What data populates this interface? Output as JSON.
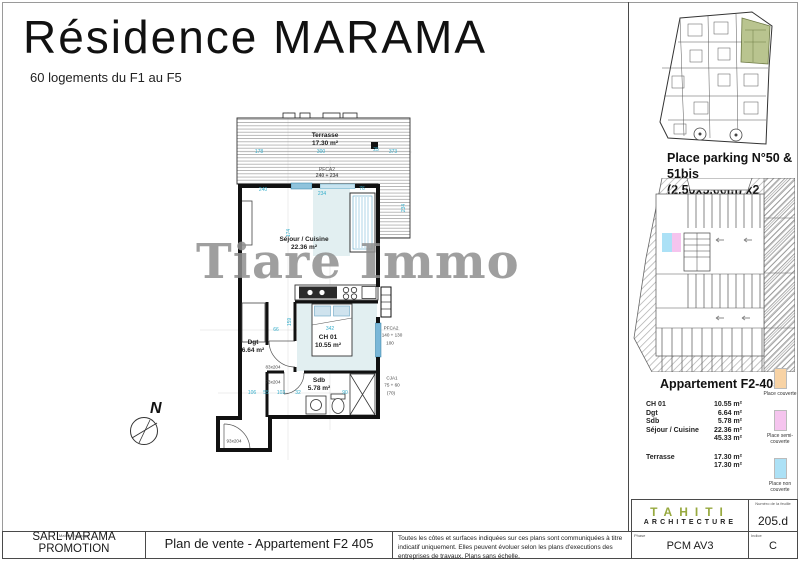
{
  "header": {
    "title": "Résidence MARAMA",
    "subtitle": "60 logements du F1 au F5"
  },
  "watermark": "Tiare Immo",
  "plan": {
    "compass": "N",
    "room_labels": [
      {
        "name": "Terrasse",
        "area": "17.30 m²",
        "x": 325,
        "y": 140
      },
      {
        "name": "PFCA2",
        "area": "240 + 234",
        "x": 327,
        "y": 173,
        "cls": "small"
      },
      {
        "name": "Séjour / Cuisine",
        "area": "22.36 m²",
        "x": 304,
        "y": 244
      },
      {
        "name": "CH 01",
        "area": "10.55 m²",
        "x": 328,
        "y": 342
      },
      {
        "name": "Dgt",
        "area": "6.64 m²",
        "x": 253,
        "y": 347
      },
      {
        "name": "Sdb",
        "area": "5.78 m²",
        "x": 319,
        "y": 385
      }
    ],
    "door_labels": [
      {
        "t": "83x204",
        "x": 273,
        "y": 367
      },
      {
        "t": "73x204",
        "x": 273,
        "y": 382
      },
      {
        "t": "93x204",
        "x": 234,
        "y": 441
      }
    ],
    "window_labels": [
      {
        "t": "PFCA2",
        "x": 391,
        "y": 328
      },
      {
        "t": "140 + 130",
        "x": 392,
        "y": 335
      },
      {
        "t": "100",
        "x": 390,
        "y": 343
      },
      {
        "t": "CJA1",
        "x": 392,
        "y": 378
      },
      {
        "t": "75 + 60",
        "x": 392,
        "y": 385
      },
      {
        "t": "(70)",
        "x": 391,
        "y": 393
      }
    ],
    "dimensions": [
      {
        "t": "178",
        "x": 259,
        "y": 152
      },
      {
        "t": "300",
        "x": 321,
        "y": 152
      },
      {
        "t": "25",
        "x": 376,
        "y": 150
      },
      {
        "t": "373",
        "x": 393,
        "y": 152
      },
      {
        "t": "240",
        "x": 263,
        "y": 190
      },
      {
        "t": "234",
        "x": 322,
        "y": 194
      },
      {
        "t": "76",
        "x": 362,
        "y": 189
      },
      {
        "t": "174",
        "x": 289,
        "y": 233,
        "rot": true
      },
      {
        "t": "159",
        "x": 290,
        "y": 322,
        "rot": true
      },
      {
        "t": "342",
        "x": 330,
        "y": 329
      },
      {
        "t": "66",
        "x": 276,
        "y": 330
      },
      {
        "t": "234",
        "x": 404,
        "y": 208,
        "rot": true
      },
      {
        "t": "106",
        "x": 252,
        "y": 393
      },
      {
        "t": "55",
        "x": 266,
        "y": 393
      },
      {
        "t": "103",
        "x": 281,
        "y": 393
      },
      {
        "t": "32",
        "x": 298,
        "y": 393
      },
      {
        "t": "90",
        "x": 345,
        "y": 393
      }
    ]
  },
  "sidebar": {
    "parking_title": [
      "Place parking N°50 & 51bis",
      "(2.50x5.00m) x2"
    ],
    "apartment": {
      "title": "Appartement F2-405",
      "rows": [
        {
          "label": "CH 01",
          "value": "10.55 m²"
        },
        {
          "label": "Dgt",
          "value": "6.64 m²"
        },
        {
          "label": "Sdb",
          "value": "5.78 m²"
        },
        {
          "label": "Séjour / Cuisine",
          "value": "22.36 m²"
        },
        {
          "label": "",
          "value": "45.33 m²"
        },
        {
          "label": "Terrasse",
          "value": "17.30 m²",
          "gap": true
        },
        {
          "label": "",
          "value": "17.30 m²"
        }
      ]
    },
    "legend": [
      {
        "label": "Place couverte",
        "color": "#f8d3a5"
      },
      {
        "label": "Place semi-couverte",
        "color": "#f5c4ee"
      },
      {
        "label": "Place non couverte",
        "color": "#ace1f6"
      }
    ]
  },
  "titleblock": {
    "owner_label": "Maître d'ouvrage",
    "owner_value": "SARL MARAMA PROMOTION",
    "plan_title": "Plan de vente - Appartement F2 405",
    "disclaimer": "Toutes les côtes et surfaces indiquées sur ces plans sont communiquées à titre indicatif uniquement. Elles peuvent évoluer selon les plans d'executions des entreprises de travaux. Plans sans échelle.",
    "logo_line1": "TAHITI",
    "logo_line2": "ARCHITECTURE",
    "sheet_label": "Numéro de la feuille",
    "sheet_number": "205.d",
    "phase_label": "Phase",
    "phase_value": "PCM AV3",
    "index_label": "Indice",
    "index_value": "C"
  }
}
